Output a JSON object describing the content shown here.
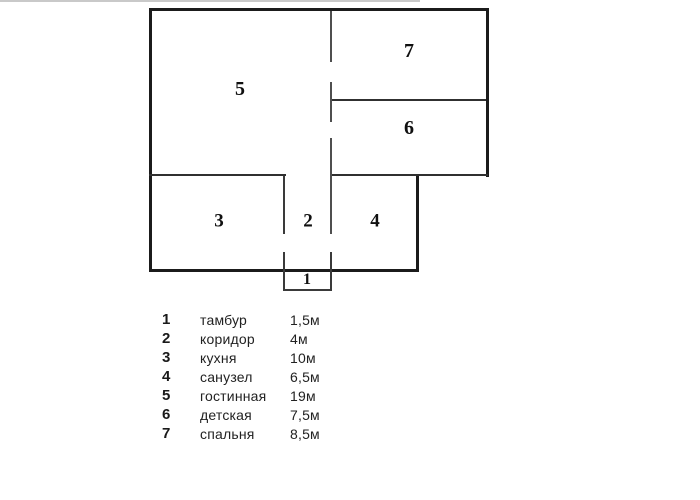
{
  "rooms": [
    {
      "number": "1",
      "name": "тамбур",
      "area": "1,5м"
    },
    {
      "number": "2",
      "name": "коридор",
      "area": "4м"
    },
    {
      "number": "3",
      "name": "кухня",
      "area": "10м"
    },
    {
      "number": "4",
      "name": "санузел",
      "area": "6,5м"
    },
    {
      "number": "5",
      "name": "гостинная",
      "area": "19м"
    },
    {
      "number": "6",
      "name": "детская",
      "area": "7,5м"
    },
    {
      "number": "7",
      "name": "спальня",
      "area": "8,5м"
    }
  ],
  "colors": {
    "wall_outer": "#1b1b1b",
    "wall_inner": "#303030",
    "wall_dashed": "#4f4f4f",
    "text": "#222222",
    "background": "#ffffff",
    "scan_border": "#c9c9c9"
  }
}
